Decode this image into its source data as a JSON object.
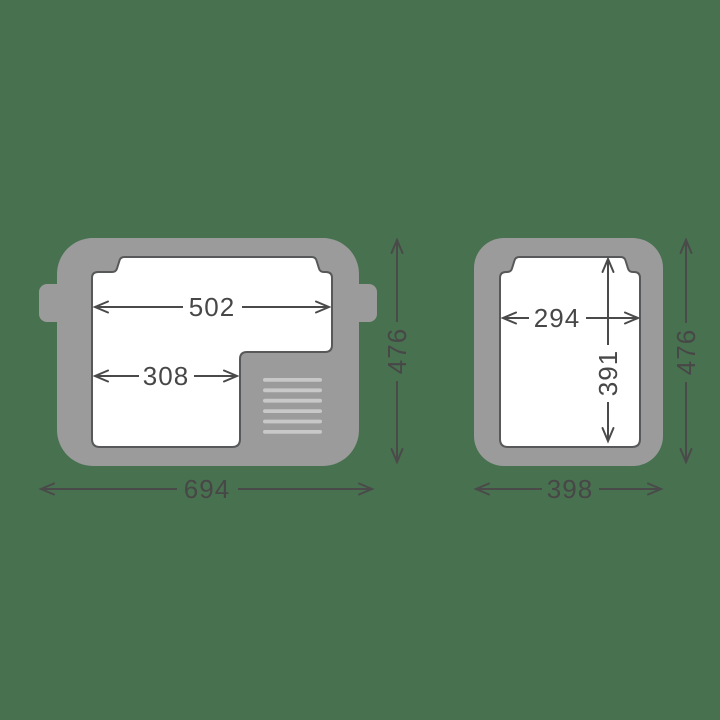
{
  "diagram": {
    "kind": "product-dimension-drawing",
    "units_shown": "mm (implied, numbers only)",
    "colors": {
      "background": "#48714F",
      "body_gray": "#9B9B9B",
      "cavity_white": "#FFFFFF",
      "cavity_outline": "#57585A",
      "dimension_gray": "#4A4A4A",
      "vent_light_gray": "#C8C8C8"
    },
    "top_view": {
      "labels": {
        "inner_width_full": "502",
        "inner_width_front": "308",
        "outer_width": "694",
        "outer_depth": "476"
      }
    },
    "front_view": {
      "labels": {
        "inner_width": "294",
        "inner_height": "391",
        "outer_width": "398",
        "outer_height": "476"
      }
    }
  }
}
